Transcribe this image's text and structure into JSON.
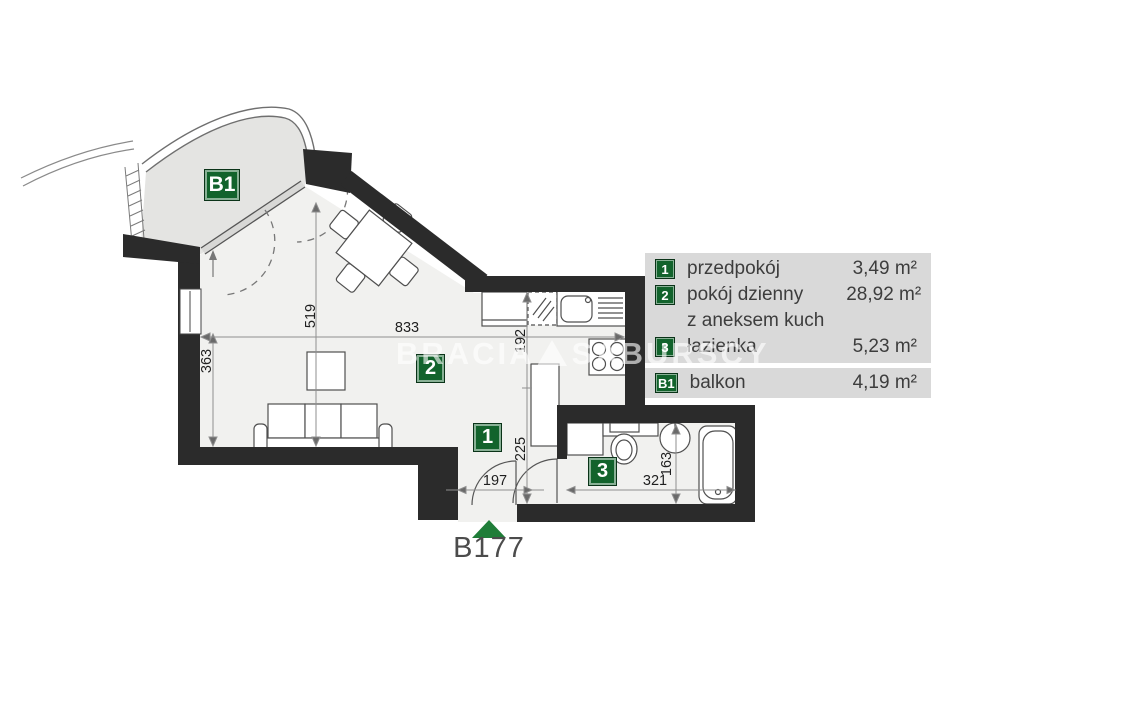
{
  "unit": {
    "label": "B177"
  },
  "watermark": {
    "text_left": "BRACIA",
    "text_right": "SABURSCY",
    "logo_icon": "triangle"
  },
  "legend": {
    "rows": [
      {
        "badge": "1",
        "name": "przedpokój",
        "area": "3,49 m²"
      },
      {
        "badge": "2",
        "name": "pokój dzienny",
        "name_line2": "z aneksem kuch",
        "area": "28,92 m²"
      },
      {
        "badge": "3",
        "name": "łazienka",
        "area": "5,23 m²"
      }
    ],
    "balcony_row": {
      "badge": "B1",
      "name": "balkon",
      "area": "4,19 m²"
    }
  },
  "plan": {
    "room_badges": {
      "hall": "1",
      "living": "2",
      "bath": "3",
      "balcony": "B1"
    },
    "dimensions": {
      "living_width": "833",
      "living_height": "519",
      "left_height": "363",
      "kitchen_depth": "192",
      "hall_depth": "225",
      "entry_width": "197",
      "bath_width": "321",
      "bath_height": "163"
    }
  },
  "colors": {
    "badge_green": "#12632c",
    "marker_green": "#1f7d38",
    "legend_bg": "#d9d9d9",
    "wall": "#2b2b2b",
    "floor": "#f1f1ef",
    "balcony": "#e4e4e2"
  }
}
